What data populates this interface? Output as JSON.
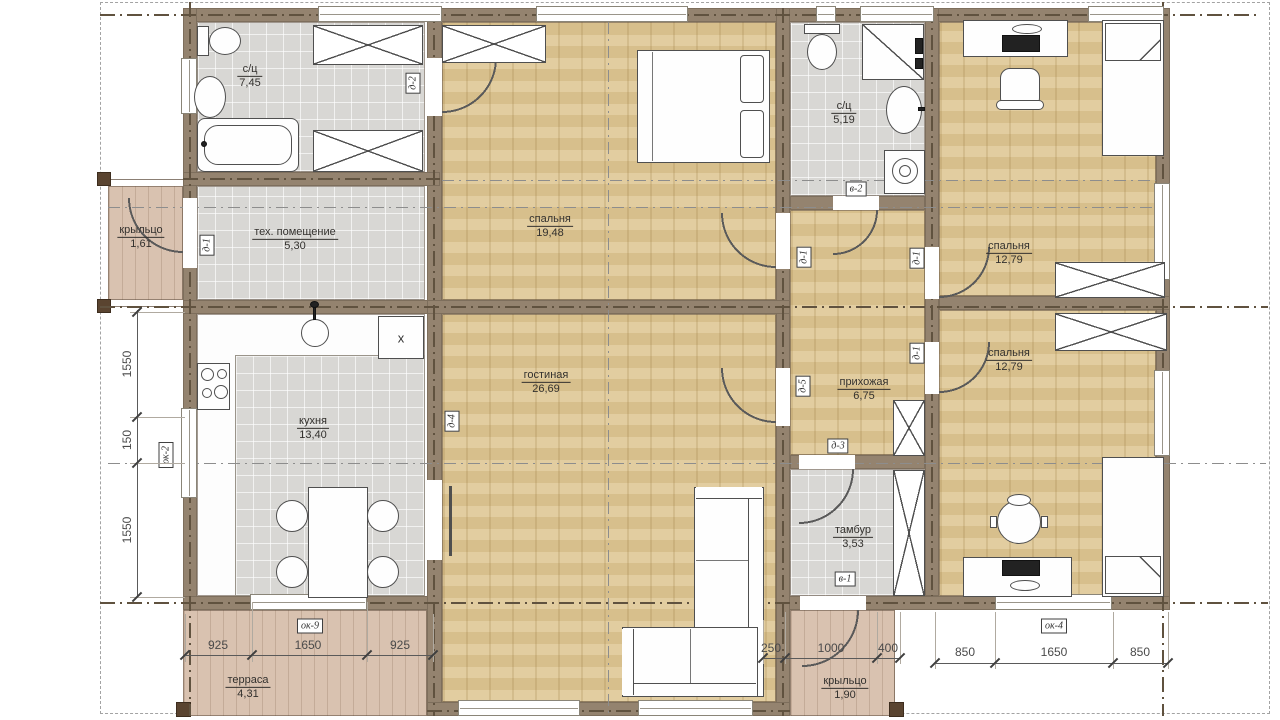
{
  "title": "floor-plan",
  "rooms": [
    {
      "name": "с/ц",
      "area": "7,45"
    },
    {
      "name": "тех. помещение",
      "area": "5,30"
    },
    {
      "name": "крыльцо",
      "area": "1,61"
    },
    {
      "name": "спальня",
      "area": "19,48"
    },
    {
      "name": "с/ц",
      "area": "5,19"
    },
    {
      "name": "спальня",
      "area": "12,79"
    },
    {
      "name": "кухня",
      "area": "13,40"
    },
    {
      "name": "гостиная",
      "area": "26,69"
    },
    {
      "name": "прихожая",
      "area": "6,75"
    },
    {
      "name": "спальня",
      "area": "12,79"
    },
    {
      "name": "тамбур",
      "area": "3,53"
    },
    {
      "name": "терраса",
      "area": "4,31"
    },
    {
      "name": "крыльцо",
      "area": "1,90"
    }
  ],
  "door_labels": [
    "д-2",
    "д-1",
    "д-4",
    "в-2",
    "д-1",
    "д-1",
    "д-1",
    "д-5",
    "д-3",
    "в-1"
  ],
  "window_labels": [
    "ок-2",
    "ок-9",
    "ок-4"
  ],
  "fixtures": {
    "boiler_label": "x"
  },
  "dims": {
    "left": [
      "1550",
      "150",
      "1550"
    ],
    "bottom_left": [
      "925",
      "1650",
      "925"
    ],
    "bottom_mid": [
      "250",
      "1000",
      "400"
    ],
    "bottom_right": [
      "850",
      "1650",
      "850"
    ]
  },
  "colors": {
    "wall": "#94836f",
    "wood": "#dfc795",
    "tile": "#d8d7d4",
    "deck": "#d9c2b0",
    "line": "#4f4f4f"
  }
}
